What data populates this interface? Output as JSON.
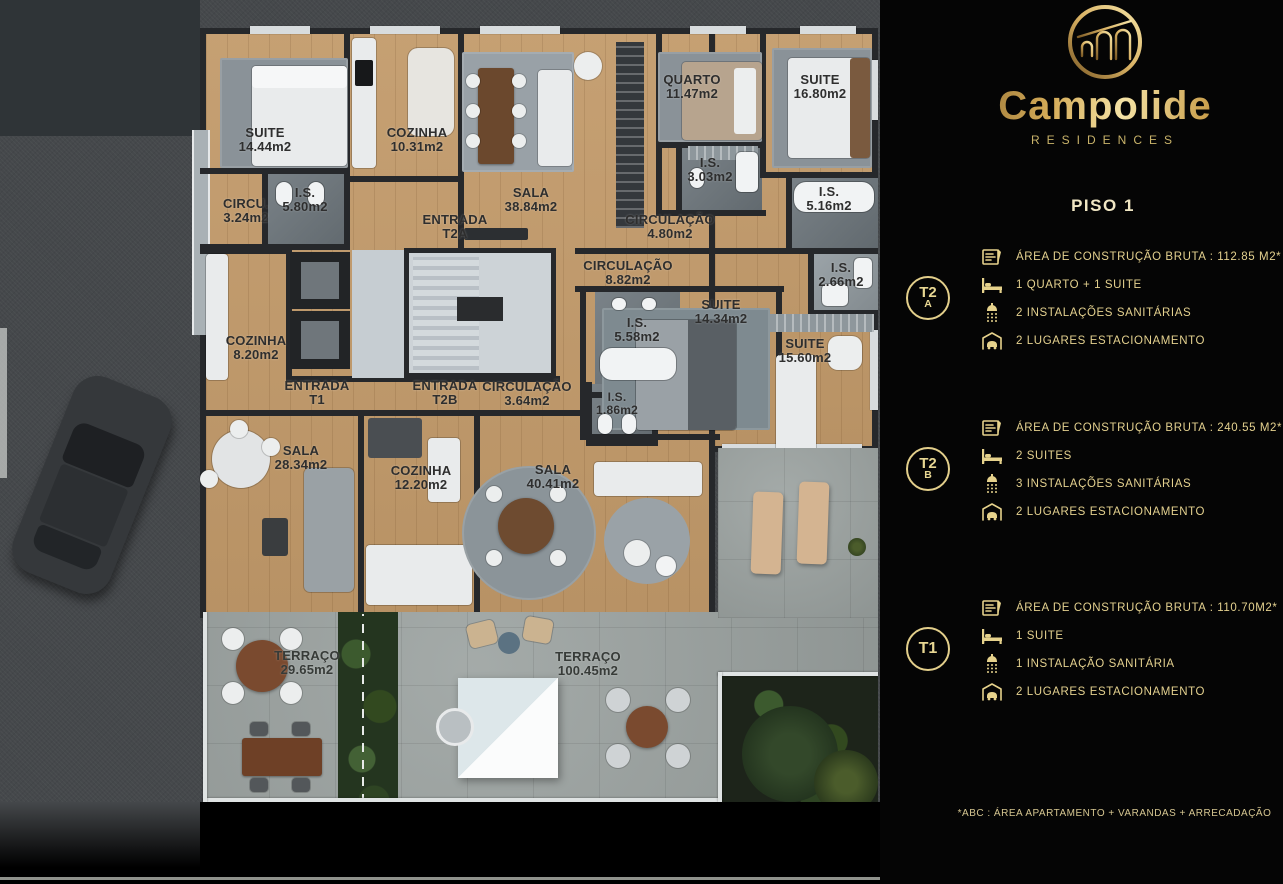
{
  "brand": {
    "name": "Campolide",
    "tagline": "RESIDENCES",
    "floor_title": "PISO 1",
    "footnote": "*ABC :  ÁREA APARTAMENTO + VARANDAS + ARRECADAÇÃO"
  },
  "colors": {
    "gold": "#e4d18f",
    "panel_bg": "#050505",
    "wood": "#c29a6a",
    "stone": "#9aa19f",
    "wall": "#26282b"
  },
  "units": [
    {
      "badge": "T2",
      "badge_sub": "A",
      "specs": [
        {
          "icon": "floorplan-icon",
          "text": "ÁREA DE CONSTRUÇÃO BRUTA :  112.85 M2*"
        },
        {
          "icon": "bed-icon",
          "text": "1 QUARTO + 1 SUITE"
        },
        {
          "icon": "shower-icon",
          "text": "2 INSTALAÇÕES SANITÁRIAS"
        },
        {
          "icon": "garage-icon",
          "text": "2 LUGARES ESTACIONAMENTO"
        }
      ]
    },
    {
      "badge": "T2",
      "badge_sub": "B",
      "specs": [
        {
          "icon": "floorplan-icon",
          "text": "ÁREA DE CONSTRUÇÃO BRUTA :  240.55 M2*"
        },
        {
          "icon": "bed-icon",
          "text": "2 SUITES"
        },
        {
          "icon": "shower-icon",
          "text": "3 INSTALAÇÕES SANITÁRIAS"
        },
        {
          "icon": "garage-icon",
          "text": "2 LUGARES ESTACIONAMENTO"
        }
      ]
    },
    {
      "badge": "T1",
      "badge_sub": "",
      "specs": [
        {
          "icon": "floorplan-icon",
          "text": "ÁREA DE CONSTRUÇÃO BRUTA :  110.70M2*"
        },
        {
          "icon": "bed-icon",
          "text": "1 SUITE"
        },
        {
          "icon": "shower-icon",
          "text": "1 INSTALAÇÃO SANITÁRIA"
        },
        {
          "icon": "garage-icon",
          "text": "2 LUGARES ESTACIONAMENTO"
        }
      ]
    }
  ],
  "plan": {
    "rooms": [
      {
        "name": "SUITE",
        "area": "14.44m2"
      },
      {
        "name": "COZINHA",
        "area": "10.31m2"
      },
      {
        "name": "CIRCU.",
        "area": "3.24m2"
      },
      {
        "name": "I.S.",
        "area": "5.80m2"
      },
      {
        "name": "ENTRADA",
        "area": "T2A"
      },
      {
        "name": "SALA",
        "area": "38.84m2"
      },
      {
        "name": "CIRCULAÇÃO",
        "area": "4.80m2"
      },
      {
        "name": "QUARTO",
        "area": "11.47m2"
      },
      {
        "name": "SUITE",
        "area": "16.80m2"
      },
      {
        "name": "I.S.",
        "area": "3.03m2"
      },
      {
        "name": "I.S.",
        "area": "5.16m2"
      },
      {
        "name": "CIRCULAÇÃO",
        "area": "8.82m2"
      },
      {
        "name": "I.S.",
        "area": "2.66m2"
      },
      {
        "name": "SUITE",
        "area": "14.34m2"
      },
      {
        "name": "I.S.",
        "area": "5.58m2"
      },
      {
        "name": "SUITE",
        "area": "15.60m2"
      },
      {
        "name": "I.S.",
        "area": "1.86m2"
      },
      {
        "name": "COZINHA",
        "area": "8.20m2"
      },
      {
        "name": "ENTRADA",
        "area": "T1"
      },
      {
        "name": "ENTRADA",
        "area": "T2B"
      },
      {
        "name": "CIRCULAÇÃO",
        "area": "3.64m2"
      },
      {
        "name": "SALA",
        "area": "28.34m2"
      },
      {
        "name": "COZINHA",
        "area": "12.20m2"
      },
      {
        "name": "SALA",
        "area": "40.41m2"
      },
      {
        "name": "TERRAÇO",
        "area": "29.65m2"
      },
      {
        "name": "TERRAÇO",
        "area": "100.45m2"
      }
    ]
  }
}
